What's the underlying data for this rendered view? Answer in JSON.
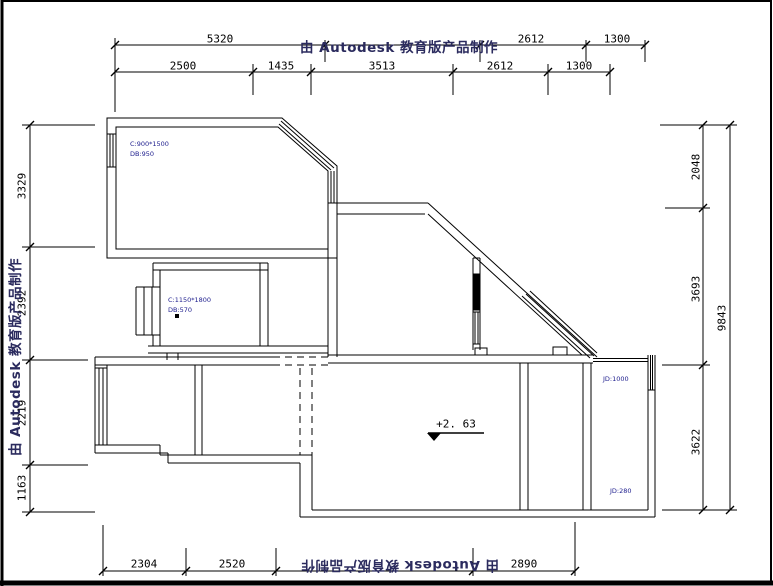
{
  "title": "floor-plan-cad-drawing",
  "watermark": {
    "text": "由 Autodesk 教育版产品制作",
    "color": "#2b2b5e"
  },
  "dimensions": {
    "top_row1": [
      "5320",
      "2612",
      "1300"
    ],
    "top_row2": [
      "2500",
      "1435",
      "3513",
      "2612",
      "1300"
    ],
    "left": [
      "3329",
      "2392",
      "2219",
      "1163"
    ],
    "right_inner": [
      "2048",
      "3693",
      "3622"
    ],
    "right_outer": [
      "9843"
    ],
    "bottom": [
      "2304",
      "2520",
      "2890"
    ]
  },
  "annotations": {
    "window_a_line1": "C:900*1500",
    "window_a_line2": "DB:950",
    "window_b_line1": "C:1150*1800",
    "window_b_line2": "DB:570",
    "jd_upper": "JD:1000",
    "jd_lower": "JD:280",
    "level_value": "+2. 63"
  },
  "colors": {
    "wall_line": "#000000",
    "annotation_text": "#1b1b8c",
    "watermark_text": "#2b2b5e"
  }
}
